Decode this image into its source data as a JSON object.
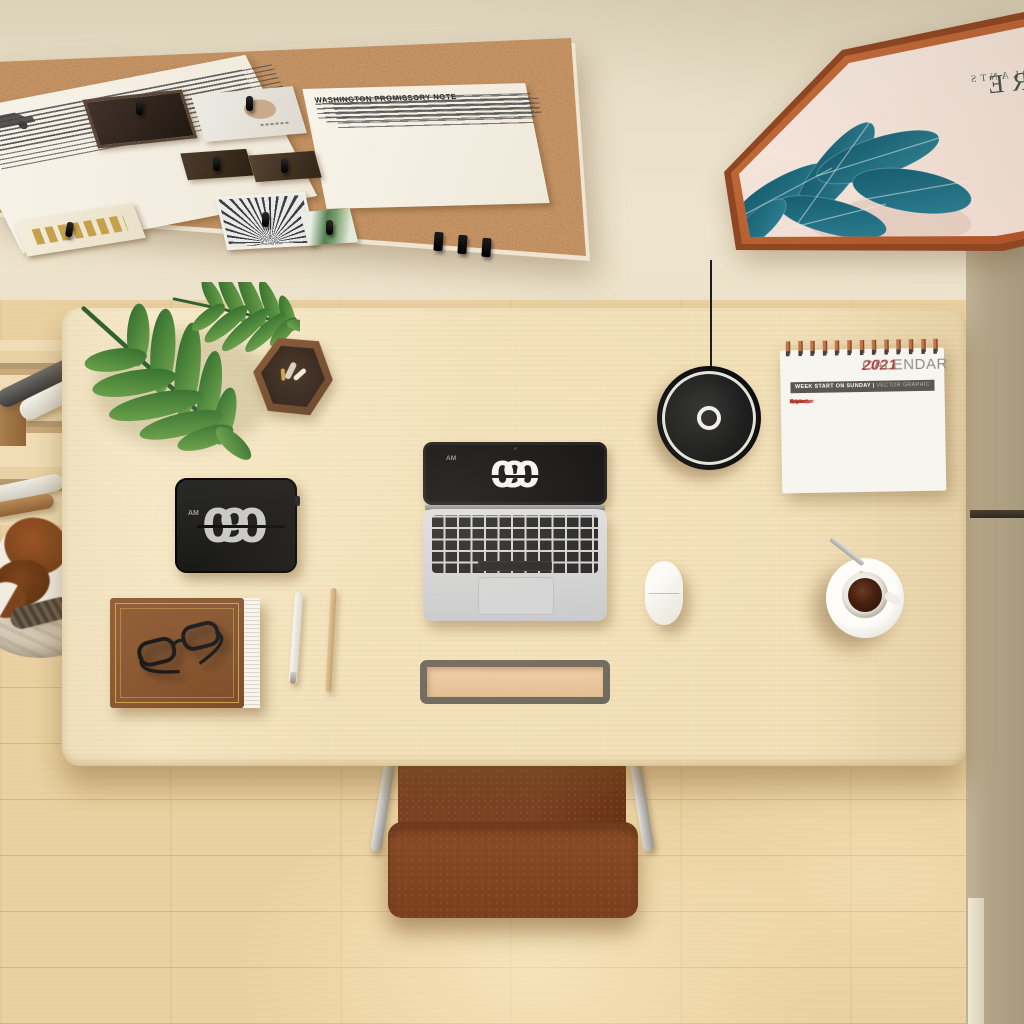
{
  "scene": {
    "description": "Top-down 3D rendered view of a home office: light wood desk with laptop, flip clocks, lamp, calendar, coffee; cork pin board and hexagonal plant poster on the wall; leather chair and sleeping cat on a wood floor",
    "colors": {
      "wall": "#e9dfc8",
      "right_wall": "#b3a486",
      "floor_wood": "#ebd1a1",
      "desk_wood": "#f2e0b8",
      "cork": "#c78d55",
      "frame_terracotta": "#b0592c",
      "poster_leaf_teal": "#1d6b7c",
      "monstera_green": "#3f7a38",
      "chair_leather": "#82451f",
      "calendar_red": "#c13327",
      "clock_black": "#141414"
    }
  },
  "corkboard": {
    "note_title": "WASHINGTON PROMISSORY NOTE"
  },
  "wall_frame": {
    "text_line1": "RE",
    "text_line2": "PLANTS",
    "note": "text printed mirrored on poster"
  },
  "desk_clock": {
    "meridiem": "AM",
    "hour": "9",
    "minutes": "00"
  },
  "laptop": {
    "screen_clock": {
      "meridiem": "AM",
      "hour": "9",
      "minutes": "00"
    }
  },
  "calendar": {
    "year": "2021",
    "title": "CALENDAR",
    "subtitle_bold": "WEEK START ON SUNDAY |",
    "subtitle_light": " VECTOR GRAPHIC",
    "months": [
      "January",
      "February",
      "March",
      "April",
      "May",
      "June",
      "July",
      "August",
      "September",
      "October",
      "November",
      "December"
    ]
  }
}
